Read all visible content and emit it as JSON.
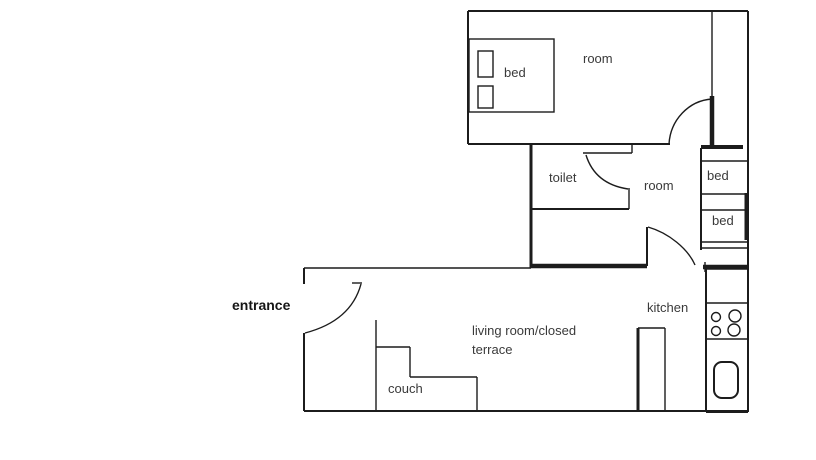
{
  "colors": {
    "line": "#1c1c1c",
    "text": "#3a3a3a",
    "background": "#ffffff"
  },
  "rooms": {
    "top_room": {
      "label": "room"
    },
    "toilet": {
      "label": "toilet"
    },
    "middle_room": {
      "label": "room"
    },
    "kitchen": {
      "label": "kitchen"
    },
    "living_room": {
      "label_line1": "living room/closed",
      "label_line2": "terrace"
    },
    "entrance": {
      "label": "entrance"
    }
  },
  "furniture": {
    "double_bed": {
      "label": "bed"
    },
    "closet_bed_upper": {
      "label": "bed"
    },
    "closet_bed_lower": {
      "label": "bed"
    },
    "couch": {
      "label": "couch"
    },
    "stove": {
      "burner_count": 4
    }
  }
}
